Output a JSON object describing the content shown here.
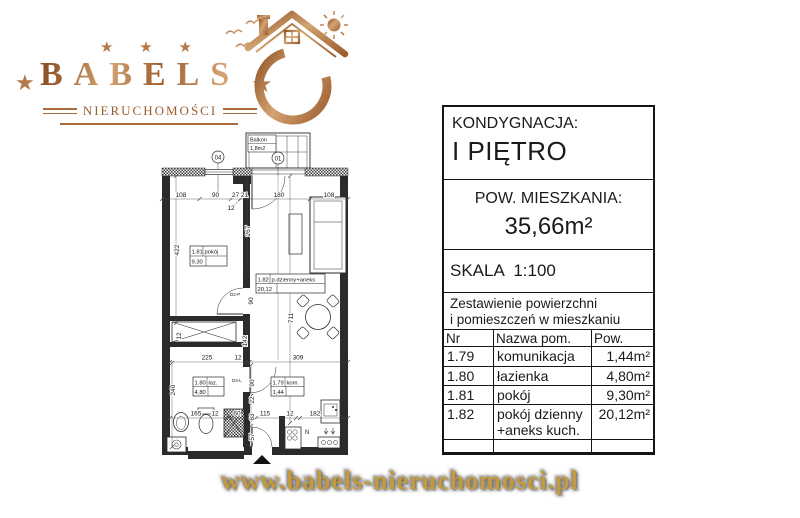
{
  "logo": {
    "brand": "BABELS",
    "subtitle": "NIERUCHOMOŚCI",
    "star": "★",
    "colors": {
      "copper": "#a96b3d",
      "copper_light": "#d3a371",
      "copper_dark": "#8f5226"
    }
  },
  "footer": {
    "url": "www.babels-nieruchomosci.pl",
    "gold": "#c49a3e"
  },
  "info_panel": {
    "floor_label": "KONDYGNACJA:",
    "floor_value": "I PIĘTRO",
    "area_label": "POW. MIESZKANIA:",
    "area_value": "35,66m²",
    "scale_label": "SKALA  1:100",
    "summary_line1": "Zestawienie powierzchni",
    "summary_line2": "i pomieszczeń w mieszkaniu",
    "table": {
      "headers": [
        "Nr pom.",
        "Nazwa pom.",
        "Pow. pom."
      ],
      "rows": [
        {
          "nr": "1.79",
          "name": "komunikacja",
          "name2": "",
          "area": "1,44m²"
        },
        {
          "nr": "1.80",
          "name": "łazienka",
          "name2": "",
          "area": "4,80m²"
        },
        {
          "nr": "1.81",
          "name": "pokój",
          "name2": "",
          "area": "9,30m²"
        },
        {
          "nr": "1.82",
          "name": "pokój dzienny",
          "name2": "+aneks kuch.",
          "area": "20,12m²"
        }
      ]
    }
  },
  "floorplan": {
    "balcony": {
      "name": "Balkon",
      "area": "1,8m2"
    },
    "axes": {
      "a04": "04",
      "a01": "01"
    },
    "rooms": {
      "r181": {
        "nr": "1.81",
        "name": "pokój",
        "area": "9,30"
      },
      "r182": {
        "nr": "1.82",
        "name": "p.dzienny+aneks",
        "area": "20,12"
      },
      "r180": {
        "nr": "1.80",
        "name": "łaz.",
        "area": "4,80"
      },
      "r179": {
        "nr": "1.79",
        "name": "kom.",
        "area": "1,44"
      }
    },
    "doors": {
      "d2p": "D2-P",
      "d3l": "D3-L"
    },
    "kitchen_mark": "N",
    "dims": {
      "top": [
        "108",
        "90",
        "27",
        "21",
        "180",
        "108"
      ],
      "top_small": "12",
      "left": [
        "422",
        "240"
      ],
      "mid_v": [
        "267",
        "90",
        "142",
        "12",
        "711"
      ],
      "right_v": [
        "90",
        "22",
        "63",
        "57"
      ],
      "mid_h": [
        "225",
        "12",
        "309"
      ],
      "bottom": [
        "165",
        "12",
        "60",
        "115",
        "12",
        "182"
      ]
    }
  }
}
